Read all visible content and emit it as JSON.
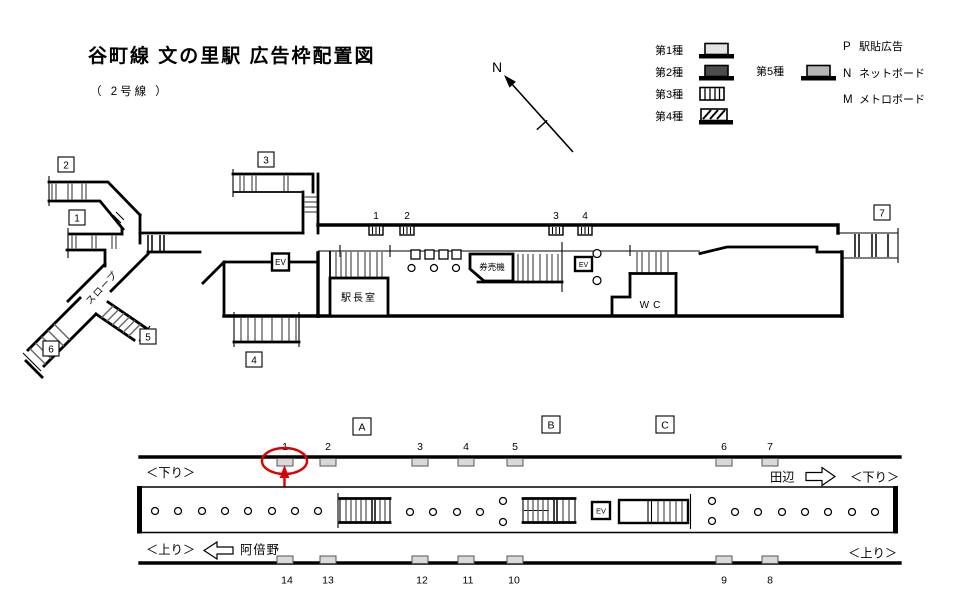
{
  "page": {
    "title": "谷町線 文の里駅 広告枠配置図",
    "subtitle": "（ 2号線 ）"
  },
  "compass": {
    "label": "N"
  },
  "legend": {
    "types": [
      {
        "label": "第1種"
      },
      {
        "label": "第2種"
      },
      {
        "label": "第3種"
      },
      {
        "label": "第4種"
      },
      {
        "label": "第5種"
      }
    ],
    "codes": [
      {
        "key": "P",
        "label": "駅貼広告"
      },
      {
        "key": "N",
        "label": "ネットボード"
      },
      {
        "key": "M",
        "label": "メトロボード"
      }
    ]
  },
  "concourse": {
    "exit_labels": [
      "1",
      "2",
      "3",
      "4",
      "5",
      "6",
      "7"
    ],
    "ad_positions": [
      "1",
      "2",
      "3",
      "4"
    ],
    "rooms": {
      "station_master": "駅長室",
      "ticket_machines": "券売機",
      "wc": "WC",
      "elevator": "EV",
      "slope": "スロープ"
    }
  },
  "platform": {
    "section_labels": [
      "A",
      "B",
      "C"
    ],
    "top_positions": [
      "1",
      "2",
      "3",
      "4",
      "5",
      "6",
      "7"
    ],
    "bottom_positions": [
      "14",
      "13",
      "12",
      "11",
      "10",
      "9",
      "8"
    ],
    "down_label": "＜下り＞",
    "up_label": "＜上り＞",
    "next_station_right": "田辺",
    "next_station_left": "阿倍野",
    "elevator": "EV"
  },
  "colors": {
    "red_accent": "#dd0000",
    "ad_box_fill": "#d9d9d9",
    "type1_fill": "#e3e3e3",
    "type2_fill": "#4d4d4d",
    "type5_fill": "#b5b5b5"
  }
}
